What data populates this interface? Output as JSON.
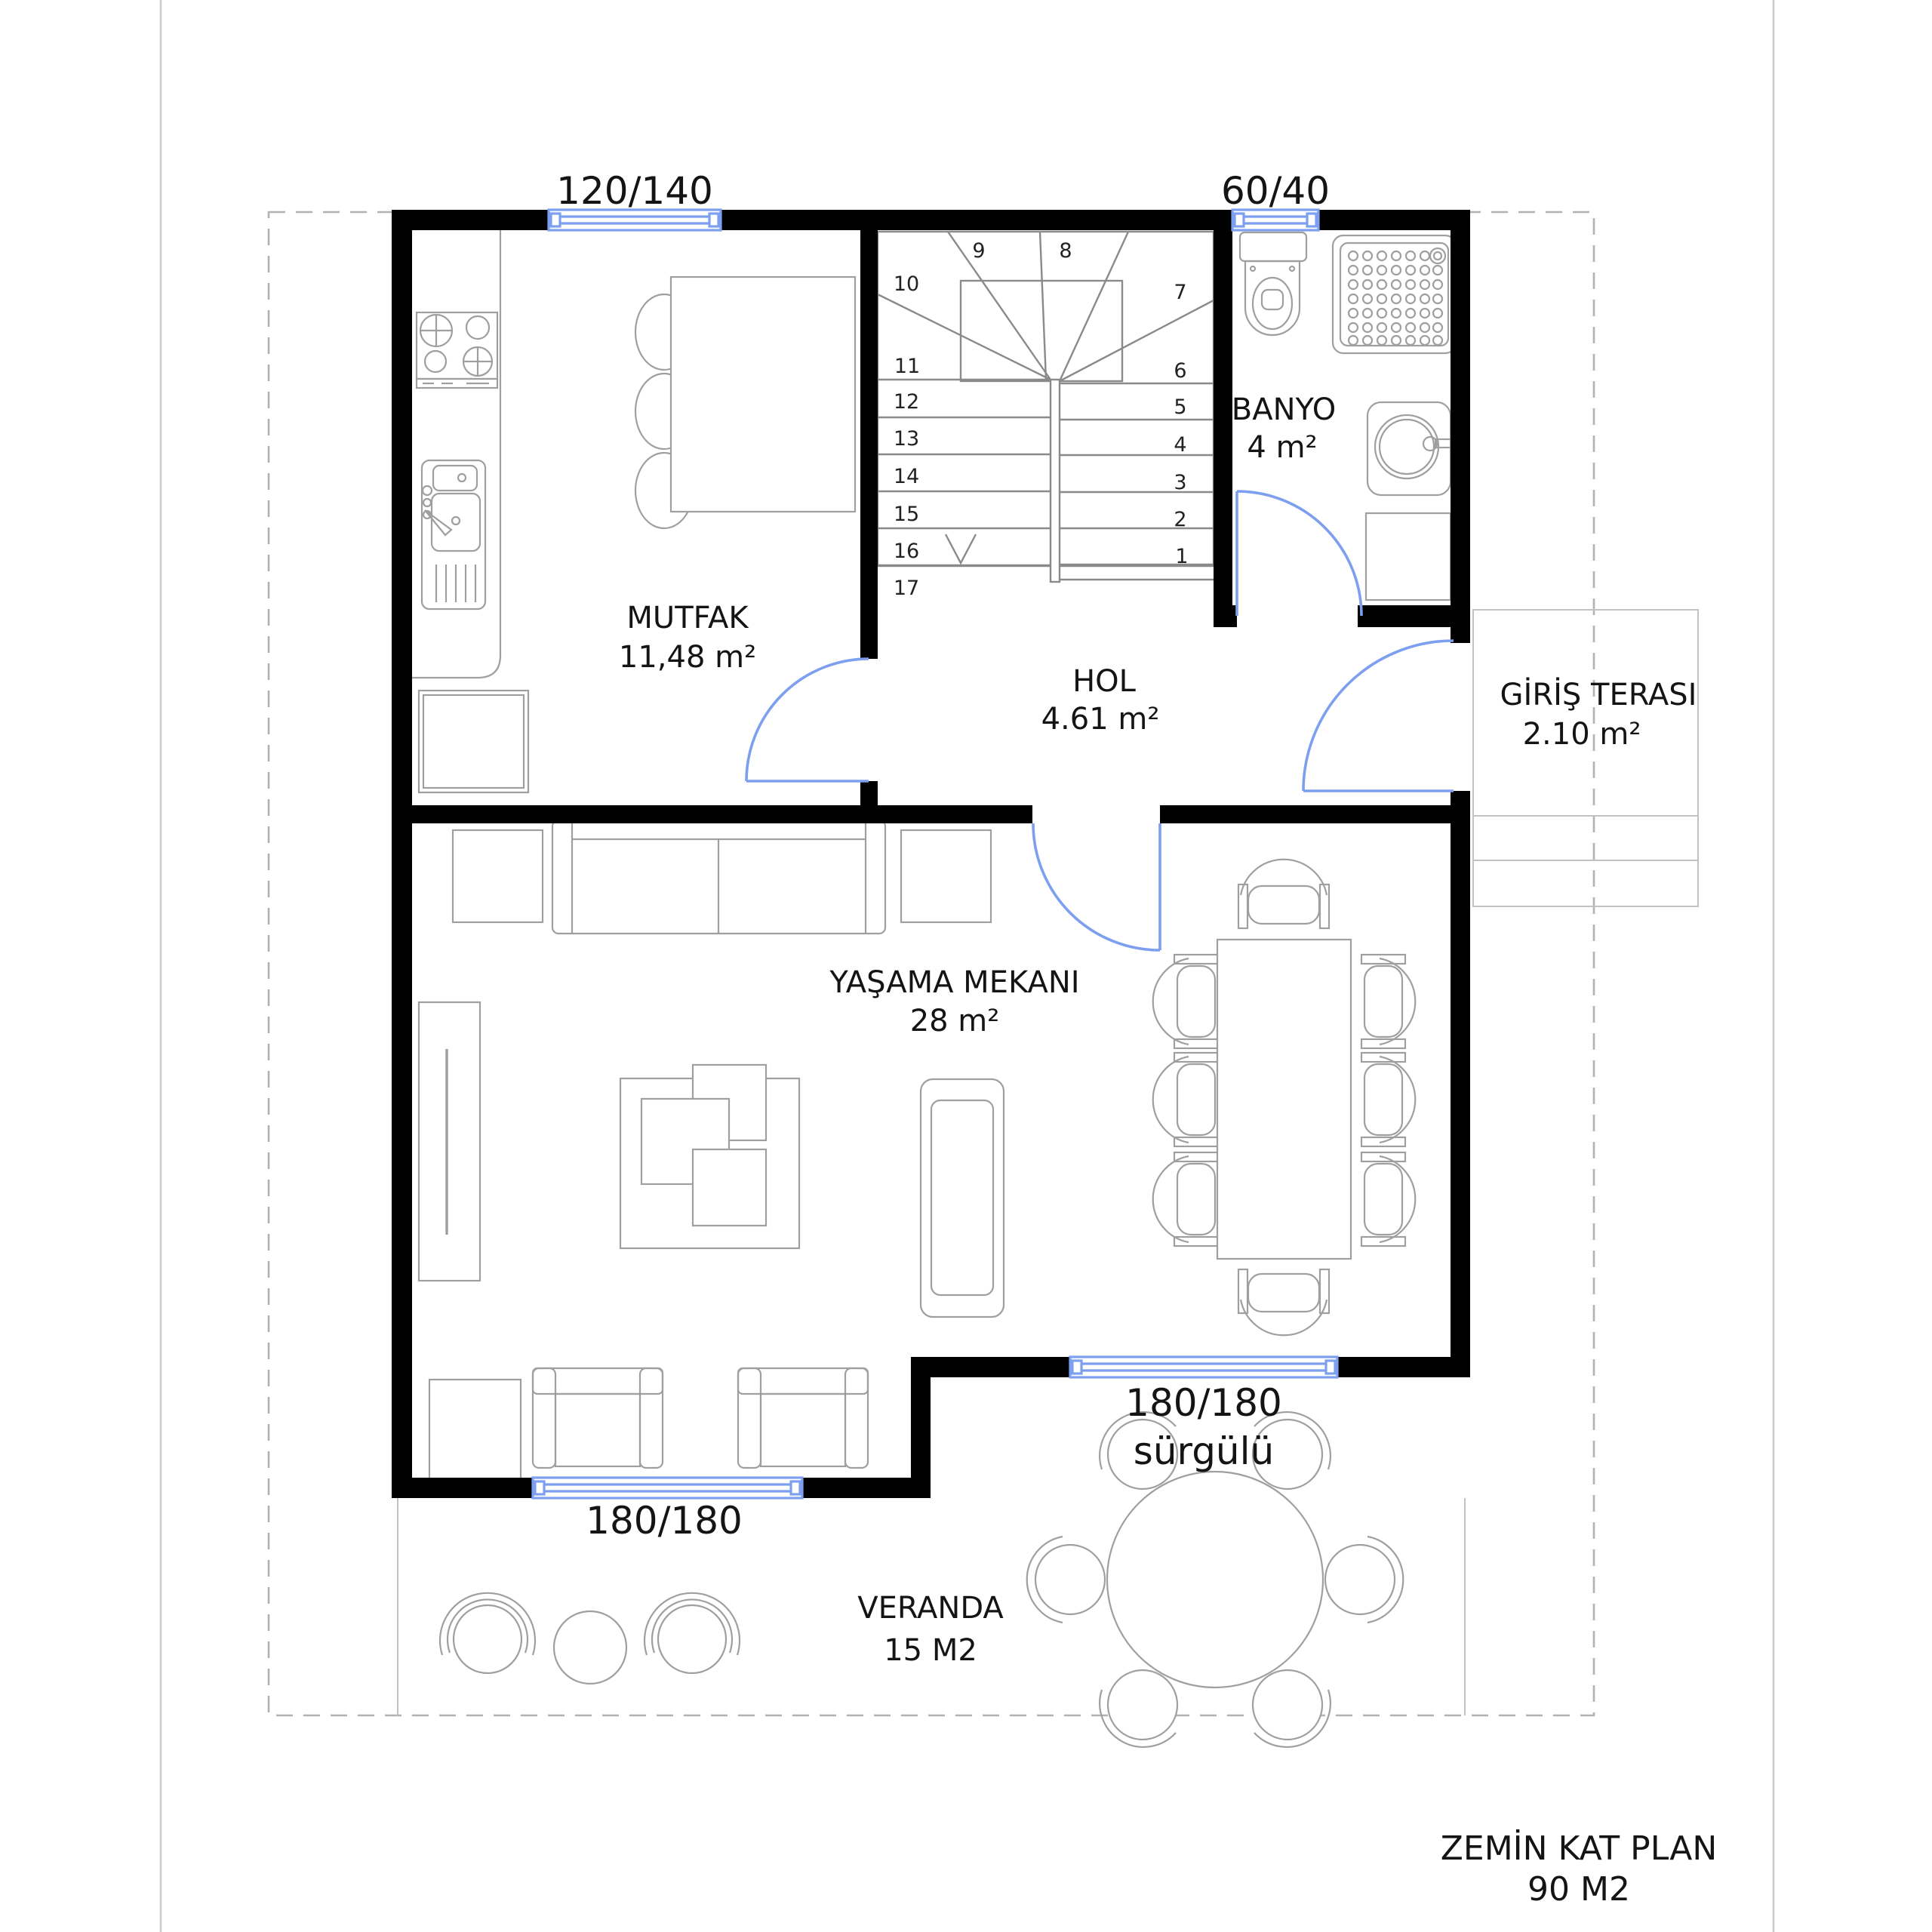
{
  "plan_title": {
    "line1": "ZEMİN KAT PLAN",
    "line2": "90 M2"
  },
  "rooms": {
    "kitchen": {
      "name": "MUTFAK",
      "area": "11,48 m²"
    },
    "hall": {
      "name": "HOL",
      "area": "4.61 m²"
    },
    "bathroom": {
      "name": "BANYO",
      "area": "4 m²"
    },
    "entry_terrace": {
      "name": "GİRİŞ TERASI",
      "area": "2.10 m²"
    },
    "living_room": {
      "name": "YAŞAMA MEKANI",
      "area": "28 m²"
    },
    "veranda": {
      "name": "VERANDA",
      "area": "15 M2"
    }
  },
  "windows": {
    "kitchen_top": "120/140",
    "bathroom_top": "60/40",
    "living_bottom_right_size": "180/180",
    "living_bottom_right_type": "sürgülü",
    "living_bottom_left": "180/180"
  },
  "stairs": {
    "numbers": [
      "1",
      "2",
      "3",
      "4",
      "5",
      "6",
      "7",
      "8",
      "9",
      "10",
      "11",
      "12",
      "13",
      "14",
      "15",
      "16",
      "17"
    ]
  },
  "colors": {
    "wall": "#000000",
    "opening": "#7d9ff0",
    "furniture": "#9f9f9f",
    "stair": "#8a8a8a",
    "boundary": "#b2b2b2",
    "page_edge": "#cccccc"
  }
}
